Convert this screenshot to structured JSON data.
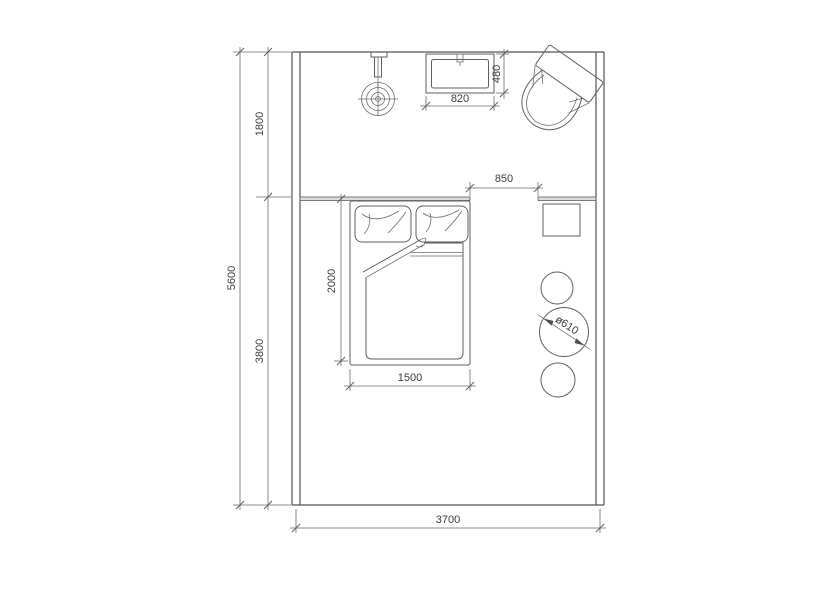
{
  "drawing": {
    "type": "bedroom floor plan (top view)",
    "background": "#ffffff",
    "line_color": "#5f5f5f",
    "text_color": "#3f3f3f"
  },
  "dims": {
    "overall_height": "5600",
    "upper_zone": "1800",
    "lower_zone": "3800",
    "room_width": "3700",
    "basin_width": "820",
    "basin_depth": "480",
    "opening": "850",
    "bed_length": "2000",
    "bed_width": "1500",
    "round_table_diameter": "ø610"
  },
  "fixtures": [
    "shower-head",
    "wash-basin",
    "toilet",
    "double-bed",
    "pillows",
    "duvet",
    "bedside-table",
    "round-table",
    "stool"
  ]
}
